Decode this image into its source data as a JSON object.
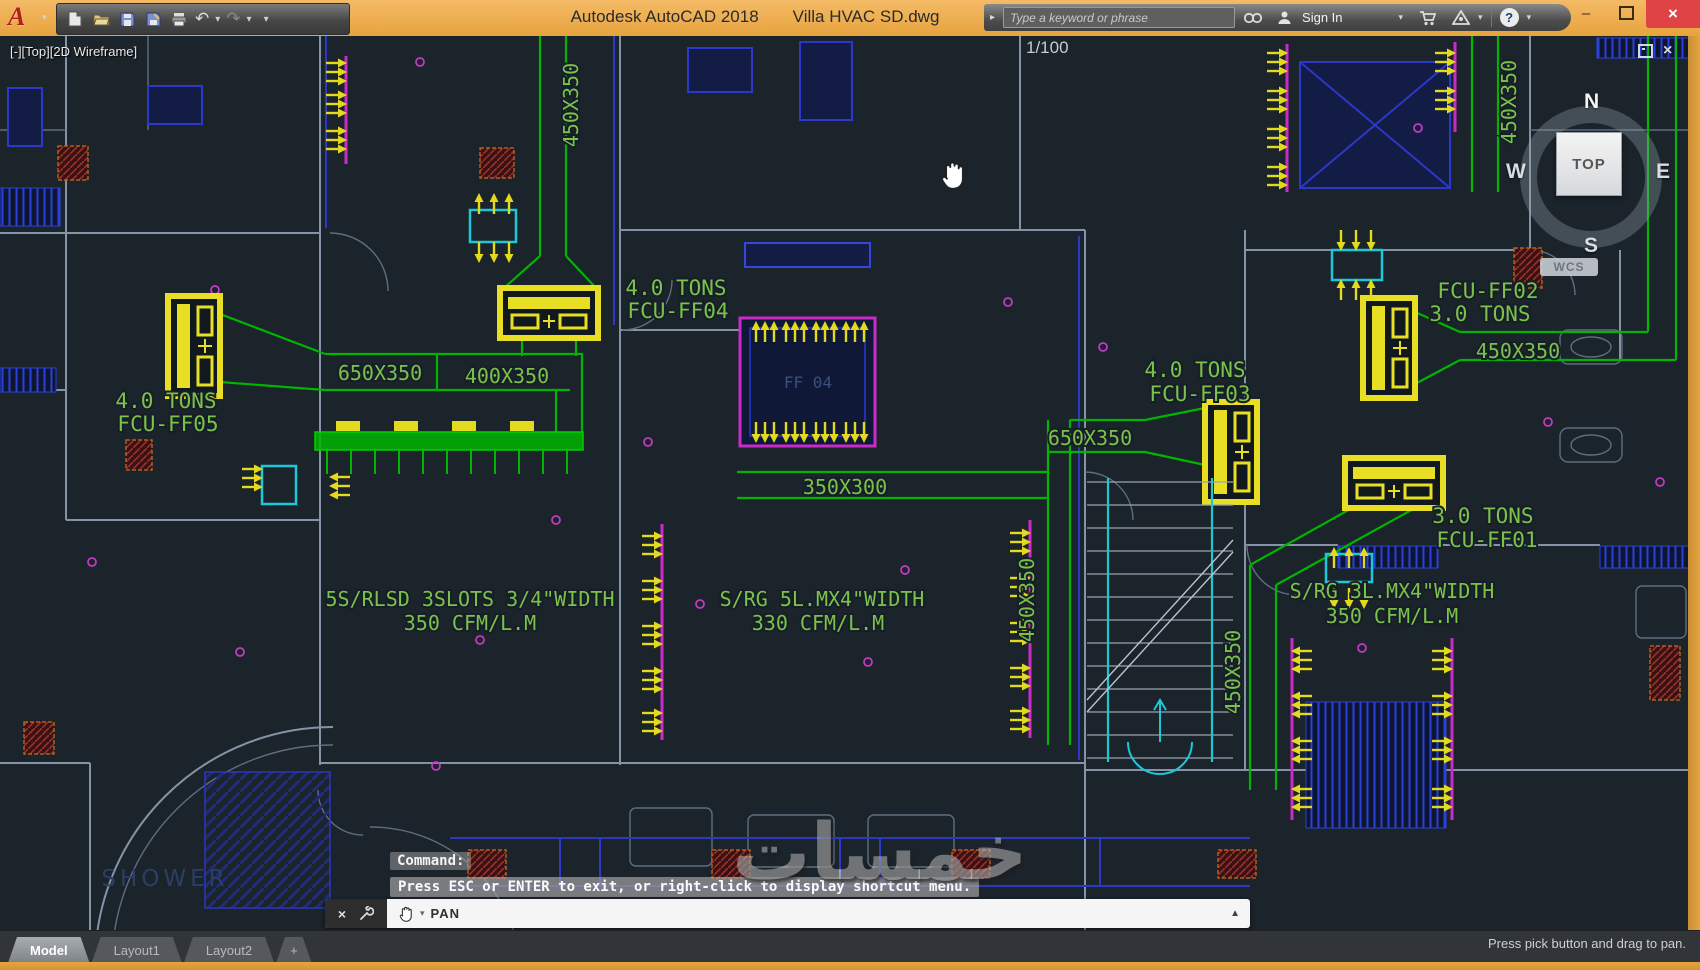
{
  "titlebar": {
    "logo": "A",
    "app_title": "Autodesk AutoCAD 2018",
    "doc_title": "Villa HVAC SD.dwg",
    "search": {
      "placeholder": "Type a keyword or phrase"
    },
    "sign_in": "Sign In"
  },
  "icons": {
    "caret_down": "▾",
    "caret_up": "▲",
    "collapse": "▸",
    "undo": "↶",
    "redo": "↷",
    "minimize": "–",
    "close": "×",
    "help": "?",
    "cmd_close": "×"
  },
  "viewport": {
    "label": "[-][Top][2D Wireframe]",
    "scale": "1/100",
    "viewcube": {
      "n": "N",
      "s": "S",
      "e": "E",
      "w": "W",
      "face": "TOP",
      "wcs": "WCS"
    }
  },
  "drawing": {
    "labels": {
      "v450_top": "450X350",
      "tons40_ff04": "4.0 TONS",
      "fcu_ff04": "FCU-FF04",
      "d650_left": "650X350",
      "d400": "400X350",
      "tons40_ff05": "4.0 TONS",
      "fcu_ff05": "FCU-FF05",
      "sr_left1": "5S/RLSD 3SLOTS 3/4\"WIDTH",
      "sr_left2": "350 CFM/L.M",
      "room_ff04": "FF 04",
      "d350x300": "350X300",
      "sr_mid1": "S/RG 5L.MX4\"WIDTH",
      "sr_mid2": "330 CFM/L.M",
      "v450_mid": "450X350",
      "d650_right": "650X350",
      "tons40_ff03": "4.0 TONS",
      "fcu_ff03": "FCU-FF03",
      "fcu_ff02": "FCU-FF02",
      "tons30_ff02": "3.0 TONS",
      "d450_right": "450X350",
      "tons30_ff01": "3.0 TONS",
      "fcu_ff01": "FCU-FF01",
      "v450_ff01": "450X350",
      "v450_topright": "450X350",
      "sr_right1": "S/RG 3L.MX4\"WIDTH",
      "sr_right2": "350 CFM/L.M",
      "shower": "SHOWER"
    },
    "colors": {
      "background": "#1B232B",
      "duct_green": "#00B400",
      "annotation_green": "#7CC24A",
      "equipment_yellow": "#E8DF25",
      "diffuser_magenta": "#C92BC9",
      "grille_cyan": "#1CC8D8",
      "wall_gray": "#8494A6",
      "wall_blue": "#2B38C8",
      "hatch_red": "#6E2424",
      "room_text_blue": "#2A3E66"
    }
  },
  "command": {
    "prompt": "Command:",
    "hint": "Press ESC or ENTER to exit, or right-click to display shortcut menu.",
    "active": "PAN"
  },
  "tabs": {
    "model": "Model",
    "layout1": "Layout1",
    "layout2": "Layout2",
    "add": "+"
  },
  "statusbar": {
    "hint": "Press pick button and drag to pan."
  },
  "watermark": "خمسات"
}
